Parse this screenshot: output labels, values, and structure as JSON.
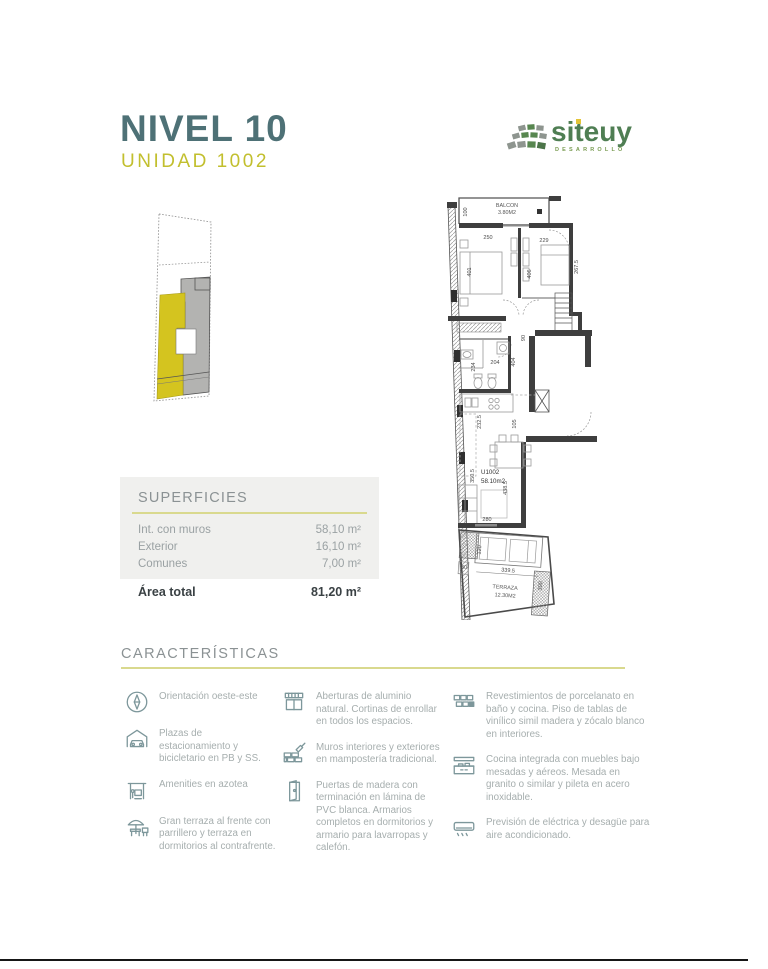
{
  "header": {
    "title": "NIVEL 10",
    "subtitle": "UNIDAD 1002"
  },
  "logo": {
    "name": "siteuy",
    "tagline": "DESARROLLO"
  },
  "plan": {
    "balcon_label": "BALCON",
    "balcon_area": "3.80M2",
    "unit_label": "U1002",
    "unit_area": "58.10m2",
    "terraza_label": "TERRAZA",
    "terraza_area": "12.30M2",
    "dims": [
      "100",
      "250",
      "229",
      "401",
      "406",
      "267.5",
      "90",
      "404",
      "204",
      "234",
      "232.5",
      "105",
      "350.5",
      "438.5",
      "280",
      "120",
      "30",
      "339.5",
      "300"
    ]
  },
  "superficies": {
    "title": "SUPERFICIES",
    "rows": [
      {
        "label": "Int. con muros",
        "value": "58,10 m²"
      },
      {
        "label": "Exterior",
        "value": "16,10 m²"
      },
      {
        "label": "Comunes",
        "value": "7,00 m²"
      }
    ],
    "total": {
      "label": "Área total",
      "value": "81,20 m²"
    }
  },
  "caracteristicas": {
    "title": "CARACTERÍSTICAS",
    "columns": [
      {
        "items": [
          {
            "icon": "compass-icon",
            "text": "Orientación oeste-este"
          },
          {
            "icon": "garage-icon",
            "text": "Plazas de estacionamiento y bicicletario en PB y SS."
          },
          {
            "icon": "amenities-icon",
            "text": "Amenities en azotea"
          },
          {
            "icon": "terrace-icon",
            "text": "Gran terraza al frente con parrillero y terraza en dormitorios al contrafrente."
          }
        ]
      },
      {
        "items": [
          {
            "icon": "window-icon",
            "text": "Aberturas de aluminio natural. Cortinas de enrollar en todos los espacios."
          },
          {
            "icon": "brick-wall-icon",
            "text": "Muros interiores y exteriores en mampostería tradicional."
          },
          {
            "icon": "door-icon",
            "text": "Puertas de madera con terminación en lámina de PVC blanca. Armarios completos en dormitorios y armario para lavarropas y calefón."
          }
        ]
      },
      {
        "items": [
          {
            "icon": "tiles-icon",
            "text": "Revestimientos de porcelanato en baño y cocina. Piso de tablas de vinílico simil madera y zócalo blanco en interiores."
          },
          {
            "icon": "kitchen-icon",
            "text": "Cocina integrada con muebles bajo mesadas y aéreos. Mesada en granito o similar y pileta en acero inoxidable."
          },
          {
            "icon": "ac-icon",
            "text": "Previsión de eléctrica y desagüe para aire acondicionado."
          }
        ]
      }
    ]
  },
  "colors": {
    "title_teal": "#4e7176",
    "accent_yellow": "#c2bf2e",
    "rule_yellow": "#d9d98e",
    "keyplan_yellow": "#d4c41f",
    "keyplan_gray": "#b3b3b1",
    "text_gray": "#9aa1a3",
    "icon_teal": "#7d979b",
    "logo_green": "#4f7e53",
    "panel_bg": "#f0f0ee"
  }
}
